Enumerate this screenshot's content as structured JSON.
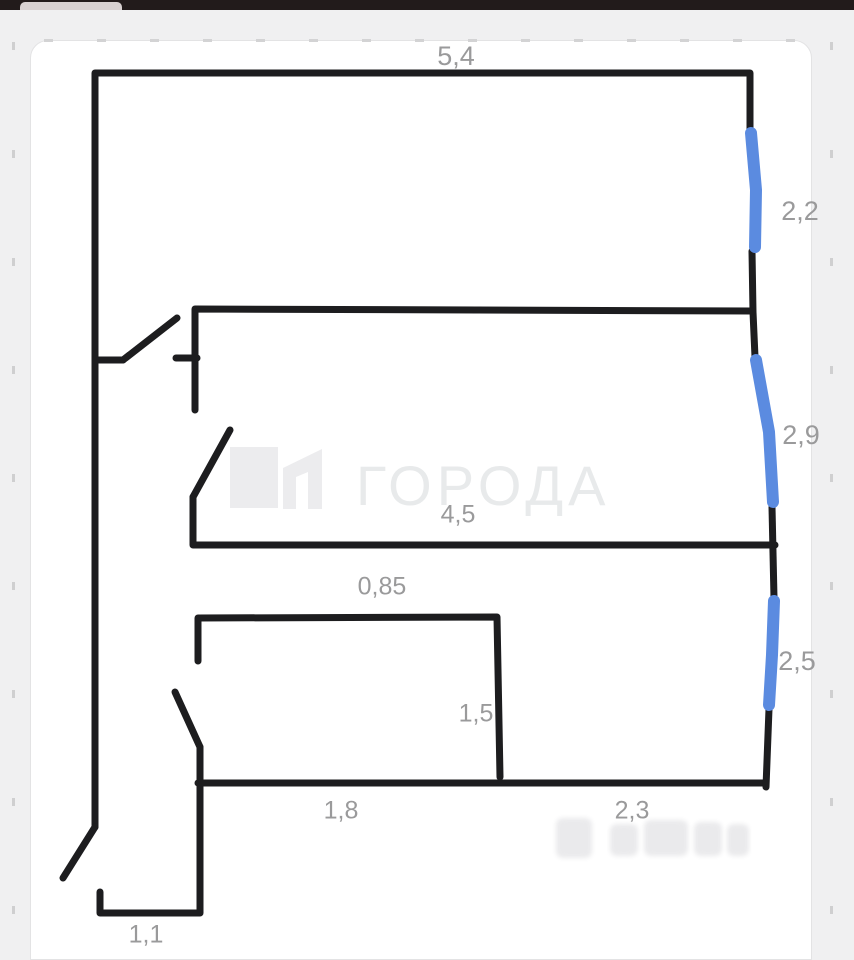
{
  "header": {
    "bar_color": "#221b1b",
    "tab_color": "#d8d1d1"
  },
  "watermark": {
    "text": "ГОРОДА",
    "logo_color": "#ececee",
    "text_color": "#e8eaeb"
  },
  "plan": {
    "wall_color": "#1d1d1f",
    "wall_width": 7,
    "window_color": "#5b8be0",
    "window_width": 12,
    "label_color": "#9a9a9b",
    "walls": [
      [
        95,
        827,
        95,
        73,
        750,
        73,
        750,
        129
      ],
      [
        752,
        251,
        753,
        312,
        755,
        357
      ],
      [
        195,
        410,
        195,
        309,
        752,
        311
      ],
      [
        176,
        358,
        197,
        358
      ],
      [
        95,
        360,
        123,
        360
      ],
      [
        123,
        360,
        177,
        318
      ],
      [
        230,
        430,
        193,
        497
      ],
      [
        193,
        497,
        193,
        545,
        775,
        545
      ],
      [
        772,
        507,
        774,
        598
      ],
      [
        198,
        661,
        198,
        618,
        497,
        617,
        500,
        777
      ],
      [
        175,
        692,
        200,
        747
      ],
      [
        200,
        747,
        200,
        913,
        100,
        913,
        100,
        892
      ],
      [
        198,
        783,
        763,
        783
      ],
      [
        769,
        709,
        766,
        787
      ],
      [
        95,
        827,
        63,
        878
      ]
    ],
    "windows": [
      [
        751,
        133,
        756,
        190,
        755,
        247
      ],
      [
        756,
        360,
        769,
        432,
        773,
        502
      ],
      [
        774,
        601,
        772,
        655,
        769,
        705
      ]
    ],
    "labels": [
      {
        "text": "5,4",
        "x": 456,
        "y": 58,
        "size": 27
      },
      {
        "text": "2,2",
        "x": 800,
        "y": 213,
        "size": 27
      },
      {
        "text": "2,9",
        "x": 801,
        "y": 437,
        "size": 27
      },
      {
        "text": "4,5",
        "x": 458,
        "y": 516,
        "size": 25
      },
      {
        "text": "0,85",
        "x": 382,
        "y": 588,
        "size": 25
      },
      {
        "text": "2,5",
        "x": 797,
        "y": 663,
        "size": 27
      },
      {
        "text": "1,5",
        "x": 476,
        "y": 715,
        "size": 25
      },
      {
        "text": "1,8",
        "x": 341,
        "y": 812,
        "size": 25
      },
      {
        "text": "2,3",
        "x": 632,
        "y": 812,
        "size": 25
      },
      {
        "text": "1,1",
        "x": 146,
        "y": 936,
        "size": 25
      }
    ],
    "logo_square": [
      230,
      447,
      48,
      61
    ],
    "logo_glyph": [
      [
        283,
        468
      ],
      [
        322,
        449
      ],
      [
        322,
        509
      ],
      [
        308,
        509
      ],
      [
        308,
        472
      ],
      [
        296,
        477
      ],
      [
        296,
        509
      ],
      [
        283,
        509
      ]
    ],
    "faint_blocks": [
      [
        556,
        818,
        36,
        40
      ],
      [
        610,
        824,
        28,
        32
      ],
      [
        644,
        820,
        44,
        36
      ],
      [
        694,
        822,
        28,
        34
      ],
      [
        727,
        824,
        22,
        32
      ]
    ],
    "faint_color": "#eaeaec"
  }
}
